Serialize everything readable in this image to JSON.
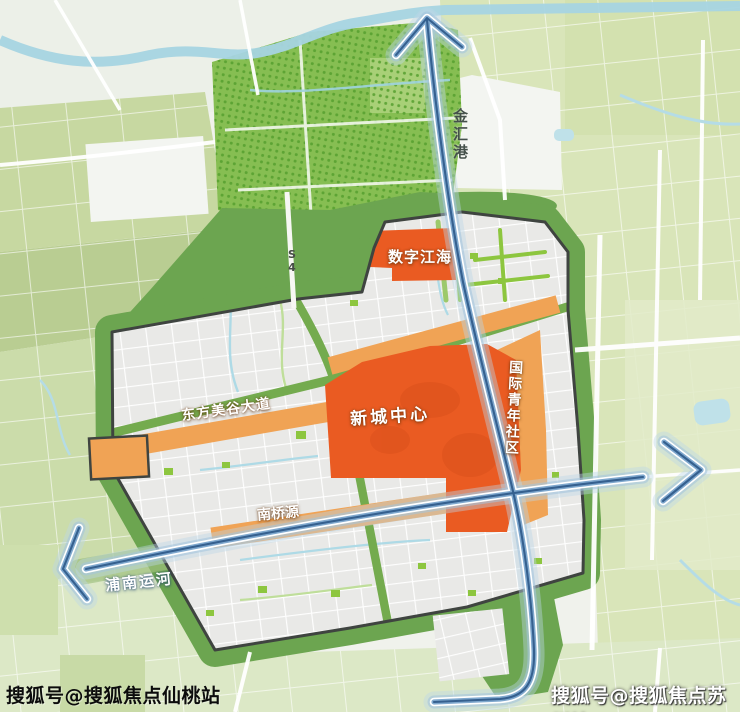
{
  "map": {
    "labels": {
      "jinhui_harbor": "金汇港",
      "digital_jianghai": "数字江海",
      "new_city_center": "新城中心",
      "international_youth_community": "国际青年社区",
      "dongfang_meigu_avenue": "东方美谷大道",
      "nanqiao_source": "南桥源",
      "punan_canal": "浦南运河",
      "highway_s": "S",
      "highway_4": "4"
    },
    "watermarks": {
      "bottom_left": "搜狐号@搜狐焦点仙桃站",
      "bottom_right": "搜狐号@搜狐焦点苏州站"
    },
    "colors": {
      "deep_orange": "#EA5B22",
      "light_orange": "#F0A355",
      "ring_green": "#6CA550",
      "road_green": "#74AB4E",
      "accent_green": "#8DC63F",
      "park_green": "#86BE52",
      "park_dot_green": "#569F2F",
      "canal_core_blue": "#35608F",
      "canal_mid_blue": "#7FA8CE",
      "canal_glow_blue": "#BCD7E8",
      "river_blue": "#A6D4E2",
      "district_gray": "#E9E9E7",
      "boundary_dark": "#3F4440",
      "field_green_light": "#D9E5B9",
      "field_green_mid": "#C3D49B"
    },
    "icons": {
      "arrow_up": "canal-flow-arrow-up",
      "arrow_right": "canal-flow-arrow-right",
      "arrow_left": "canal-flow-arrow-left"
    }
  }
}
